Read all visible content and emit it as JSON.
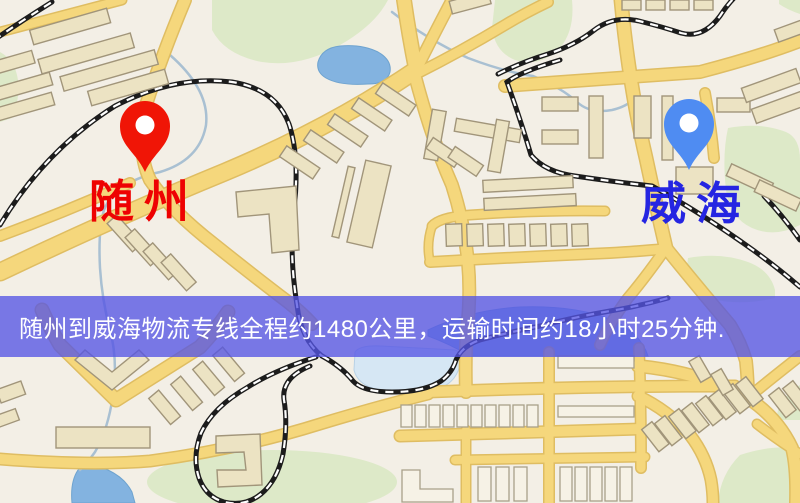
{
  "page": {
    "type": "logistics-route-map",
    "width": 800,
    "height": 503
  },
  "banner": {
    "text": "随州到威海物流专线全程约1480公里，运输时间约18小时25分钟.",
    "background": "rgba(84,84,228,0.78)",
    "text_color": "#ffffff"
  },
  "markers": {
    "origin": {
      "label": "随州",
      "label_color": "#ee0202",
      "pin_color": "#f01506"
    },
    "destination": {
      "label": "威海",
      "label_color": "#2525e2",
      "pin_color": "#4f8cf2"
    }
  },
  "route_info": {
    "origin": "随州",
    "destination": "威海",
    "service": "物流专线",
    "distance": "约1480公里",
    "duration": "约18小时25分钟"
  },
  "map": {
    "palette": {
      "background": "#f3efe6",
      "road": "#f5d77c",
      "road_casing": "#dfbd62",
      "park": "#dde9c8",
      "water": "#83b3e0",
      "water_light": "#d6e7f4",
      "stream": "#a9c0d2",
      "railway": "#1c1c1c",
      "building": "#ece3c3",
      "building_stroke": "#a1957a"
    }
  }
}
